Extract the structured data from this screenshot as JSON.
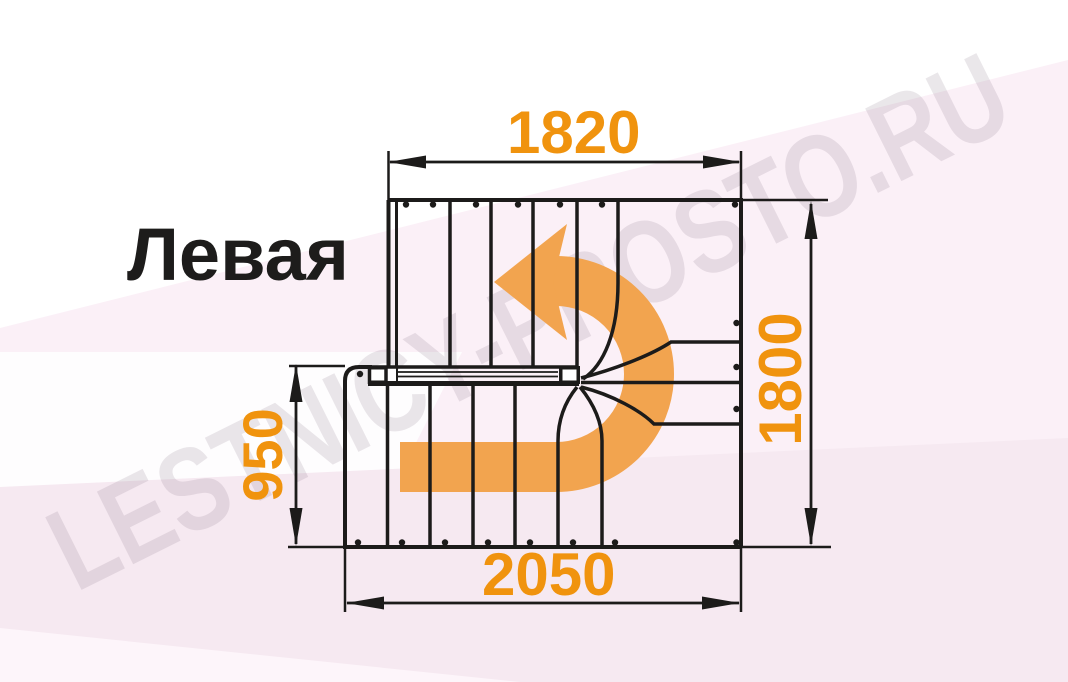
{
  "title": "Левая",
  "watermark": "LESTNICY-PROSTO.RU",
  "dimensions": {
    "top": "1820",
    "right": "1800",
    "left": "950",
    "bottom": "2050"
  },
  "drawing": {
    "type": "staircase-floor-plan",
    "turn": "180-degree left (counterclockwise) turn with winder steps",
    "flights": 2
  },
  "colors": {
    "dimension_text": "#F0930E",
    "turn_arrow": "#F2A44F",
    "lines": "#1C1B1A",
    "background_tint": "#F6E9F1"
  }
}
